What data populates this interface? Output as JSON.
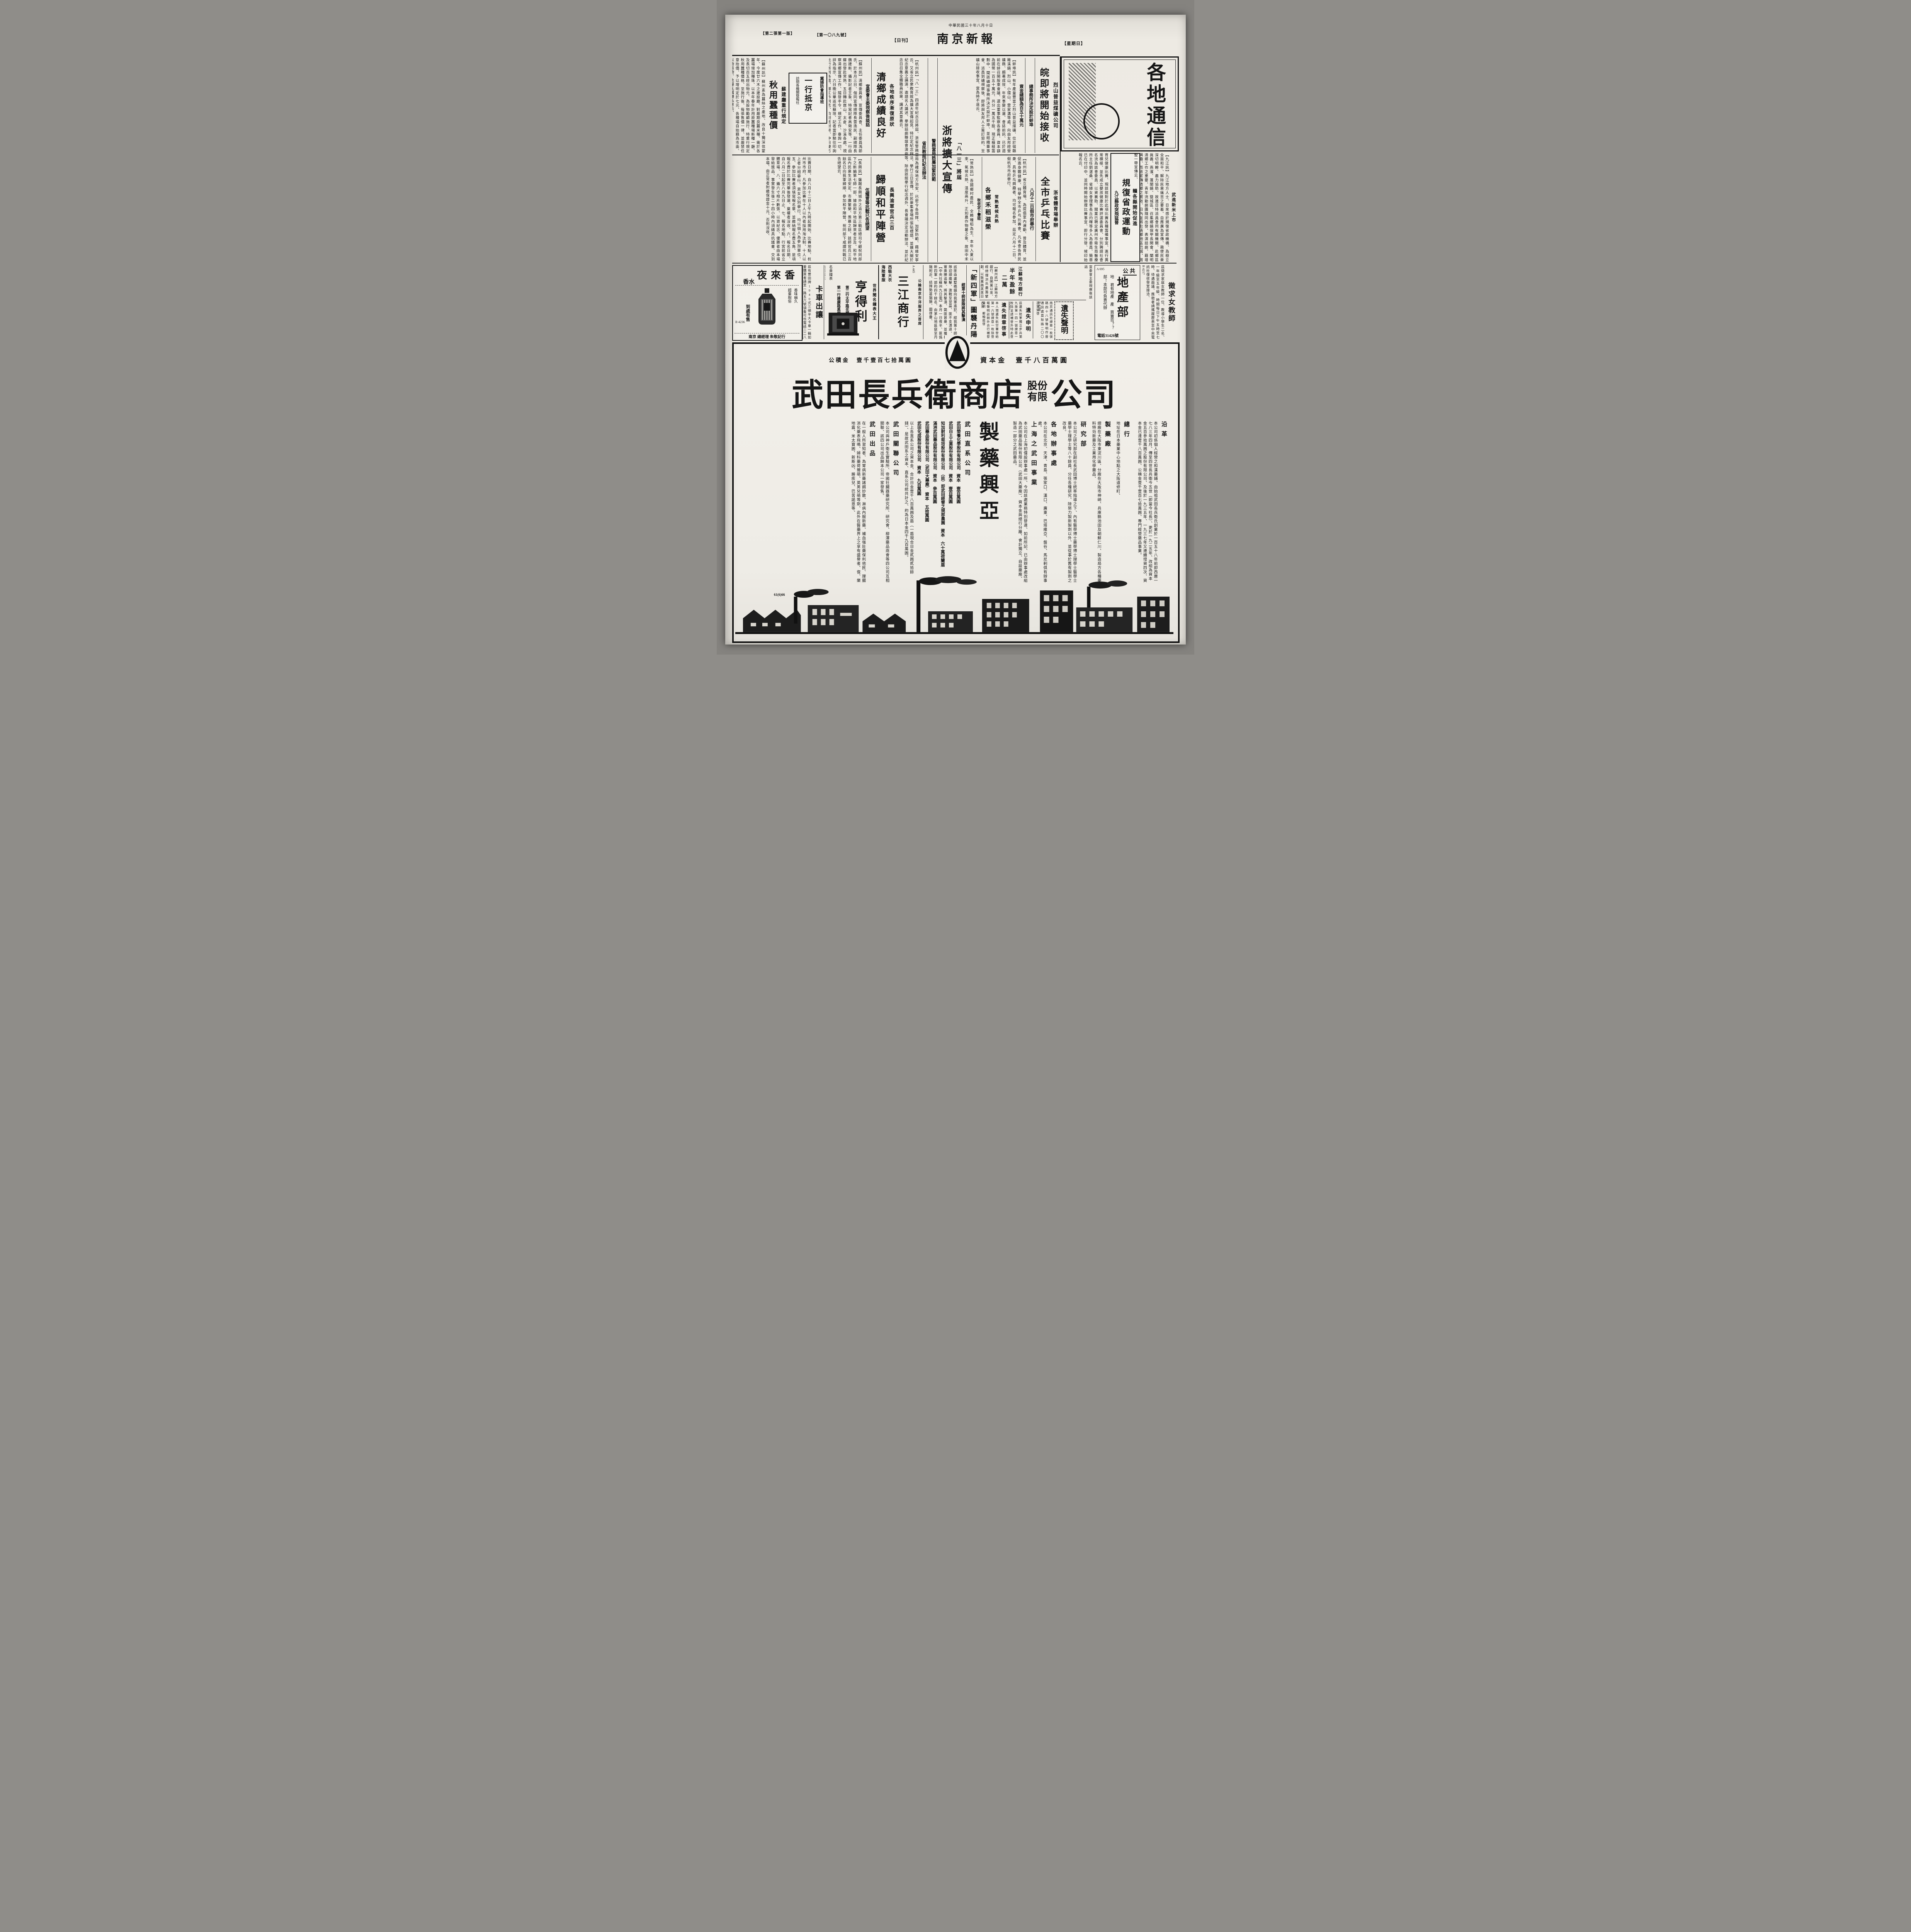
{
  "page": {
    "date_line": "中華民國三十年八月十日",
    "masthead": "南京新報",
    "daily_tag": "【日刊】",
    "weekday_tag": "【星期日】",
    "issue_no": "【第一〇八九號】",
    "edition": "【第二張第一版】",
    "section_banner": "各地通信"
  },
  "articles": {
    "coal": {
      "kicker": "烈山普益煤礦公司",
      "headline": "皖即將開始接收",
      "sub1": "總事務所決定設於蚌埠",
      "sub2": "資金總額為百五十萬元",
      "body": "【蚌埠訊】有年產量豐富之烈山普益煤礦、位於宿縣雎溪鎮、烈山、小環山、雷家溝等處、向由友邦經營礦務、頗著成效、年來事變以還、會誌前訊、已於週前在蚌召開股東會議、選出董事監察各委員、資本額為國幣一百五十萬元、共分一萬五千股、現正積極籌劃中、聞該礦總事務所決定設於蚌埠、並組織董事會、派員到礦視察後、即將與友邦人士簽訂契約、至礦山接收事宜、當為時不遠云、"
    },
    "aug13": {
      "kicker": "「八一三」將屆",
      "headline": "浙將擴大宣傳",
      "sub1": "警務當局飭屬加緊防範",
      "sub2": "省民教館訂紀念辦法",
      "body": "【杭州訊】「八一三」四週年紀念日將屆、浙省警務當局為確保地方治安、已密令各局隊、加緊防範、藉維安寧云、又省立民衆教育館為擴大宣傳起見、特訂定紀念辦法、擧行三日宣傳、於民衆集會場所張貼標語、並擴大關於紀念意義之講演、邀請名人講述、擧辦話劇聯誼會演劇等、除由該館擧行紀念週外、長會議決定活動辦法、並於紀念日召集全體職員民衆、講述其意義云、"
    },
    "qingxiang": {
      "kicker": "各地秩序漸復原狀",
      "headline": "清鄉成績良好",
      "sub": "宣委會主委視察後談話",
      "body": "【蘇州訊】清鄉委員會、宣傳委員會、主任委員馮節氏、於本月三日、偕同宣傳總隊長雷逸民、副總隊長魏建新、攝影記者王象、特寫記者高徵安等、一行由蘇出發赴常熟、五日轉赴崑山、太倉、沙溪各處、視察清鄉宣傳工作、隨發手令、規定工作、垂詢一切、詳為指示、六日晚公畢返抵蘇垣、記者當即馳往叩詢此行所到各處、鄉工作同志、均刻苦耐勞、中日雙方尤為合作、氏承發表談話如下、"
    },
    "silkworm": {
      "kicker": "蘇建廳重行規定",
      "headline": "秋用蠶種價",
      "body": "【蘇州訊】蘇州素為蠶絲之產地、改良十獨深信蒙年、今度廿六木之建設廳、對嚴期良蠶米種、需於各蠶場增加種珠、以本年春年計用原蠶種場新種一廳、及長切百五經出物元、為設物勵顧施行、特重行規定秋用蠶種價格、至施行後、每張售價一律、並嚴禁任意抬價、予以增明定於七元、各種場自始藉為市面、以物易物、免擾亂蠶種私意云、"
    },
    "hebei_box": {
      "line1": "冀婦防會指導班",
      "line2": "一行抵京",
      "line3": "訪問各機關曁報社"
    },
    "jiangxi": {
      "rice_kicker": "武進新米上市",
      "kicker": "贛各縣開始促進",
      "headline": "規復省政運動",
      "sub": "九江縣政突飛猛晉",
      "body": "【九江訊】九江地方人士、日來感於規復省政機構、為樹立全面和平、解除民衆痛苦之要着、自應廣為宣傳、務使民衆深切明瞭、盡力協助、故連日特派員會同有關機關、赴鄉區眞義、燕濱、蓬閬鎮、曁城區、召集鄉鎮保甲長開會、闡明清鄉工作之重要、青年流動劇團隨同出發、表演話劇、藉增興趣、而收宣傳清鄉之實效、日內並將赴清鄉地區巴城、周墅一帶宣傳云、"
    },
    "pingpong": {
      "kicker": "浙省體育場舉辦",
      "headline": "全市乒乓比賽",
      "sub": "八月十二日假市府舉行",
      "body": "【杭州訊】省立體育場、為提倡室內運動、普及體育、並促進身體健康、特擧辦全市乒乓比賽會、凡省會各界民衆、具有乒乓興趣者、均可報名參加、茲定八月十二日、假杭市市府擧行、"
    },
    "rules": {
      "body": "比賽日期、自八月十二日上午九時起開始、比賽地點、杭州市市府、凡參加比賽在十人以內者採用淘汰制、十人以上者分組擧行、男女分別擧行、均以個人為參加單位、五、參加比賽者須填寫報名單、並繳納報名費五角、是項報名費於比賽完畢後發還、棄權者沒收、六、報名日期、自八月二日起至八月九日止、七、報名地點、行宮前省立體育場、八、攝六寸相片數張、以資紀念、優勝者由本場發給獎品、事實發生後二十四小時內須繕具抗議書、交到本場、由正常者附繳保證金十元、否則沒收、"
    },
    "changshu": {
      "kicker": "常熟氣候炎熱",
      "headline": "各鄉禾稻滋榮",
      "sub": "秋收定卜豐稔",
      "body": "【常熟訊】吾國鄉村農民、全賴種稻為生、本年入夏以來、氣候炎熱、溫度高升、正如農作物暑之象、故田中禾稻發育異常、甚盛、雨時適勻、各鄉未曾受旱、滋榮特甚、豐收可操左券、誠昌隆之兆云、"
    },
    "changxing": {
      "kicker": "長興渝軍官兵三百",
      "headline": "歸順和平陣營",
      "sub": "伍耀萱等抗戰已告絕望",
      "body": "【長興訊】盤踞長興城外之渝方第三戰區總司令顧祝同部下之新編第七師一部、據由和平地區歸來者言及、和平地區內民衆生活安定、市廛繁榮、羨慕之餘、該師官兵三百餘名已向我軍歸順、參加和平陣營、祝同部下咸謂抗戰已告絕望云、"
    },
    "newfourth": {
      "headline": "「新四軍」圖襲丹陽",
      "sub": "經第十師部隊將其擊潰",
      "lead": "【中央社蘇州九日電】本月一日夜半、匪僞新四軍一部約四千餘名、由茅山地區竄至丹陽附近、結隊勢甚猖獗、圖啓釁、",
      "body": "該匪由盧墅橋鎮向我軍進犯、經我第十師部隊迎頭痛擊、激戰至翌晨、匪不支潰退、我軍乘勝追擊、將其擊潰、斃匪甚衆、並獲械彈多件、匪團長盧一以下百餘名即棄權沒收、現丹陽附近地區、保安隊警正着手肅清、秩序已告恢復、民衆深切明瞭、時局安定云、"
    },
    "bank": {
      "kicker": "江蘇地方銀行",
      "headline": "半年盈餘二萬",
      "body": "【蘇州訊】江蘇地方銀行、自開業以來、經總理洪氏盡籌擘劃、以致業務蒸蒸日上、貢獻良多、茲屆半年決算期間、聞該行已獲純益約在二萬元左右、"
    },
    "health": {
      "body": "育兒健康比賽、現該館對於此項比賽各種籌備事宜、進行異常積極、並先成立嬰孩健康比賽評選委員會、分別聘請社會名流為該會委員、以資襄助、聞業已聘定廣州市衛生局醫療所主任劉湛桑、省婦女會理事長丘灼暉等多人為委員、簡章已在付印中、並同時開始辦理比賽事宜、即行分發、候印始報名云、"
    }
  },
  "ads": {
    "yelaixiang": {
      "name": "夜來香",
      "product": "香水",
      "tag1": "香味幽久",
      "tag2": "超羣脫俗",
      "avail": "到處有售",
      "code": "B 4236",
      "dealer": "南京 總經理 朱敬記行"
    },
    "truck": {
      "title": "卡車出讓",
      "body": "茲有豐田牌1940式三頓半大卡車一輛如要購買者請至□路五六號領看可也電話二二八二六號",
      "code": "B 4284"
    },
    "hendeli": {
      "kicker": "世界聞名鐘表大王",
      "name": "亨得利",
      "branch1": "第一行建康路黑廊街",
      "branch2": "第二行太平路花牌樓",
      "s1": "名貴鐘表",
      "s2": "包羅萬象",
      "s3": "配光眼鏡",
      "s4": "精工修理",
      "king": "表中之王",
      "brand": "摩凡陀表"
    },
    "sanjiang": {
      "kicker": "公論南京市洋服界之首席",
      "code": "A 445",
      "name": "三江商行",
      "line1": "西裝大衣",
      "line2": "海陸軍服",
      "line3": "時裝婦女裝",
      "line4": "專家",
      "addr": "行址：建康路三山街口一〇一號",
      "addr2": "婦女成衣莊原址"
    },
    "lost1": {
      "title": "遺失聲明",
      "body": "南京通訊社證章一枚號碼四十八號聲明作廢　通訊處莫愁路二〇〇　孫寶榮啓",
      "code": "B 4289"
    },
    "lost2": {
      "title": "遺失申明",
      "body": "茲遺失陸軍獨立步兵第九旅第一四一號證章一枚除呈請補發外特此登報申明作廢　喬起華啓",
      "code": "34293"
    },
    "lost3": {
      "title": "遺失證章啓事",
      "body": "本人現遺失航空署發給第一六號證章一枚除登報聲明註銷外合行補發聲明　鄭翰庭啓",
      "code": "4288"
    },
    "estate": {
      "top": "公共",
      "big": "地產部",
      "q": "地 君有地產　產 買賣否？？",
      "a": "部！本部可負責代辦",
      "tel": "電話31426號",
      "code": "A 695"
    },
    "teacher": {
      "title": "徵求女教師",
      "body": "茲徵求家庭女教師一位、教導小學生二名、一年級至五年級、時間每日下午五時至七時、待遇面議、應徵者請攜履歷表至中央電訊社復收發室接洽、",
      "code": "B 4217"
    }
  },
  "takeda": {
    "capital": "資本金　壹千八百萬圓",
    "reserve": "公積金　壹千壹百七拾萬圓",
    "name": "武田長兵衛商店",
    "stack1": "股份",
    "stack2": "有限",
    "tail": "公司",
    "calligraphy": "製藥興亞",
    "history_t": "沿革",
    "history": "本公司初係個人經營之和漢藥鋪、由始祖武田長兵衛氏創業於一百五十八年前即西曆一七八三年四月、傳至四世長兵衛今五世（即當今社長）、更於一九二五年、改組為資本金五百參拾萬圓之股份有限公司、及後於一九三五年、一九三七年又連續增資四次、資本金已達壹千八百萬圓、公積金壹千壹百七拾萬圓、專門經營藥品事業。",
    "hq_t": "總行",
    "hq": "地址在日本藥業中心地點之大阪道修町、",
    "plant_t": "製藥廠",
    "plant": "總廠在大阪市東淀川區、分廠在大阪市神崎、兵庫縣池田及朝鮮仁川、製造局方各種藥料特効新藥及工業用化學藥品、",
    "research_t": "研究部",
    "research": "本公司之研究部在副社長武田博士統率指導之下、內有醫學博士藥學博士理學士醫學士藥學士理學士等八十餘員、分任各種研究、除努力製新製劑以外、並從事於舊有製劑之改良。",
    "offices_t": "各地辦事處",
    "offices": "本公司在北京、天津、青島、張家口、漢口、廣東、巴塔維亞、盤谷、馬尼剌俱有辦事處。",
    "shanghai_t": "上海之武田事業",
    "shanghai": "本公司在上海初僅設辦事處一所、今因該處業務特別發達、如前所記、已由辦事處改組為武田藥品股份有限公司（武田大藥廠）、資本金與總行分離、會計獨立、自設藥廠、製造一部分之武田藥品。",
    "direct_t": "武田直系公司",
    "companies": [
      {
        "name": "武田榮養化學股份有限公司",
        "cap": "資本　壹百萬圓"
      },
      {
        "name": "武田白土工業股份有限公司",
        "cap": "資本　壹百萬圓"
      },
      {
        "name": "知加耐利栽培股份有限公司　（註）即武田經營之規那農園",
        "cap": "資本　六十萬荷蘭盾"
      },
      {
        "name": "滿洲武田藥品股份有限公司",
        "cap": "資本　參百萬圓"
      },
      {
        "name": "武田藥品股份有限公司（武田大藥廠）",
        "cap": "資本　五拾萬圓"
      },
      {
        "name": "武田化成股份有限公司",
        "cap": "資本　九百萬圓"
      }
    ],
    "direct_sum": "以上各直系公司之資本金、合計日金壹千八百萬圓及盾（一盾現合日金貳圓貳拾餘錢）、是故武田系之資本、直系公司統共計之、約為日本金四千九百萬圓。",
    "related_t": "武田關聯公司",
    "related": "本公司與神戶衛生實驗所、帝國社臟器藥研究所、研究會、柳澤藥品商會等四公司互相關聯、該四公司出品歸本公司一家發售。",
    "products_t": "武田出品",
    "products": "在一般人所習知者、為胃病新藥諸餌妙散、淋病內服新藥、補血强壯藥保利他民、理腸消化藥表飛鳴、婦科藥荷爾萌、英男兒萌等劑、此外在醫藥界上之享有盛譽者、復、樂地震、米太寶圓、新斯凶、勝疾兒、巴苦諾恩等、",
    "mark": "61(6)66"
  }
}
